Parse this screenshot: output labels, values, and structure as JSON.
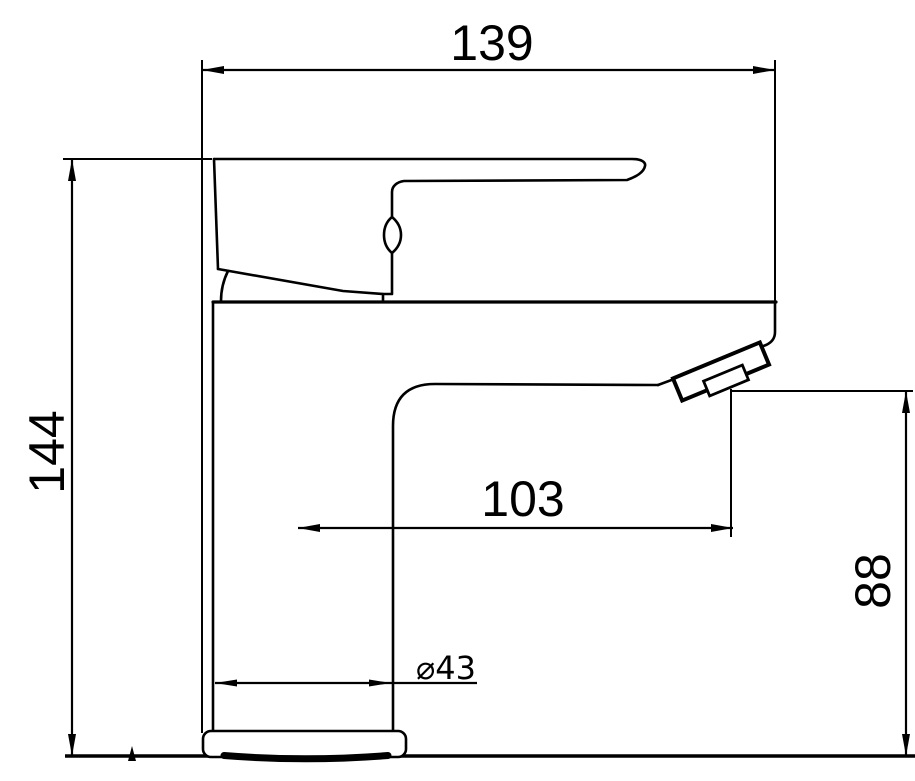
{
  "drawing": {
    "background_color": "#ffffff",
    "line_color": "#000000",
    "dimensions": {
      "overall_width": "139",
      "overall_height": "144",
      "spout_reach": "103",
      "spout_height": "88",
      "base_diameter": "⌀43"
    }
  }
}
